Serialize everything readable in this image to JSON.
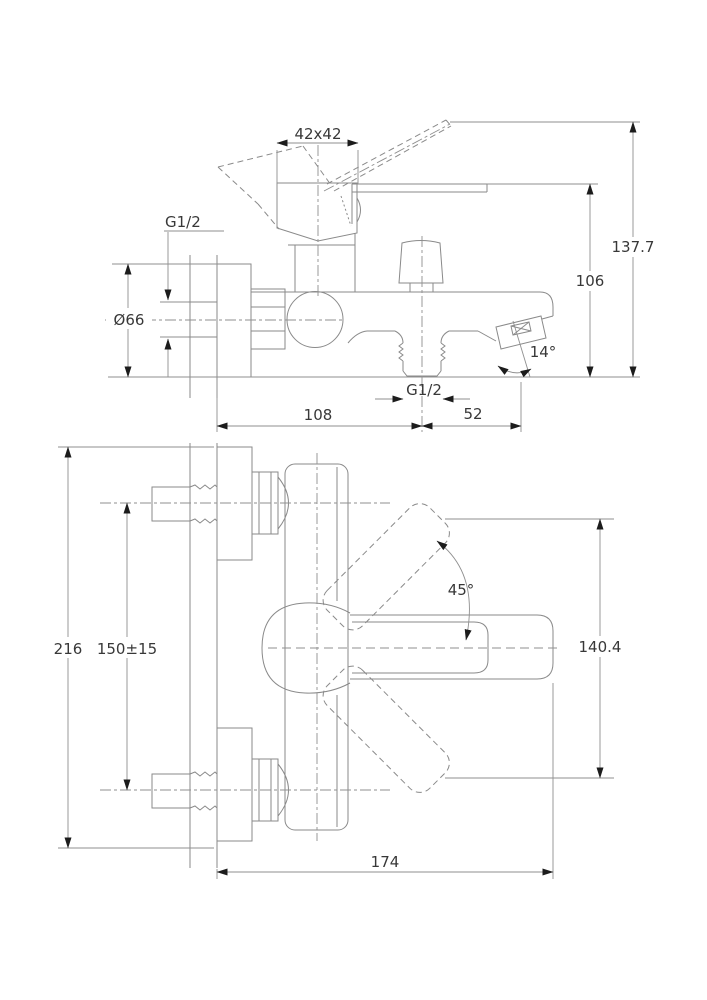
{
  "drawing": {
    "type": "technical-dimension-drawing",
    "subject": "Wall-mounted single-lever bath/shower mixer tap shown in two orthographic views with installation dimensions (mm)",
    "colors": {
      "background": "#ffffff",
      "line": "#8a8a8a",
      "dim_line": "#8f8f8f",
      "hatch": "#9b9b9b",
      "arrow": "#1c1c1c",
      "text": "#383838"
    },
    "side_view": {
      "dims": {
        "cartridge_size": "42x42",
        "wall_inlet_thread": "G1/2",
        "escutcheon_diameter": "Ø66",
        "overall_height": "137.7",
        "body_height": "106",
        "spout_angle": "14°",
        "shower_outlet_thread": "G1/2",
        "wall_to_outlet": "108",
        "outlet_to_spout": "52"
      }
    },
    "plan_view": {
      "dims": {
        "overall_width": "216",
        "connection_centres": "150±15",
        "handle_swing_angle": "45°",
        "handle_span": "140.4",
        "wall_to_spout_tip": "174"
      }
    }
  }
}
